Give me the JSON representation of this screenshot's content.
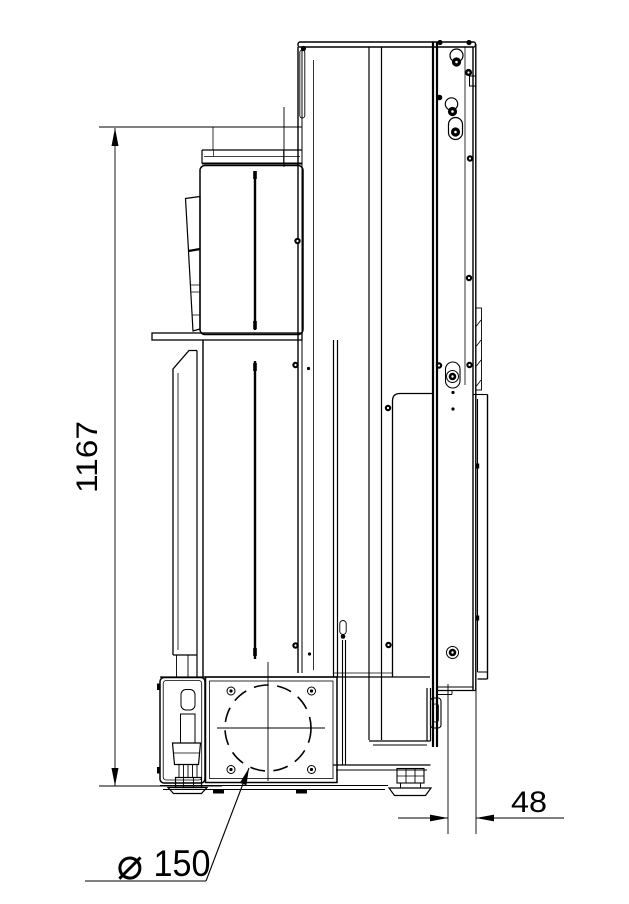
{
  "colors": {
    "background": "#ffffff",
    "line": "#000000"
  },
  "drawing": {
    "view": "side-elevation technical drawing of heating appliance",
    "annotations": {
      "height_dimension": {
        "value": "1167",
        "orientation": "vertical"
      },
      "rear_offset_dimension": {
        "value": "48",
        "orientation": "horizontal"
      },
      "flue_diameter": {
        "symbol": "⌀",
        "value": "150"
      }
    }
  }
}
